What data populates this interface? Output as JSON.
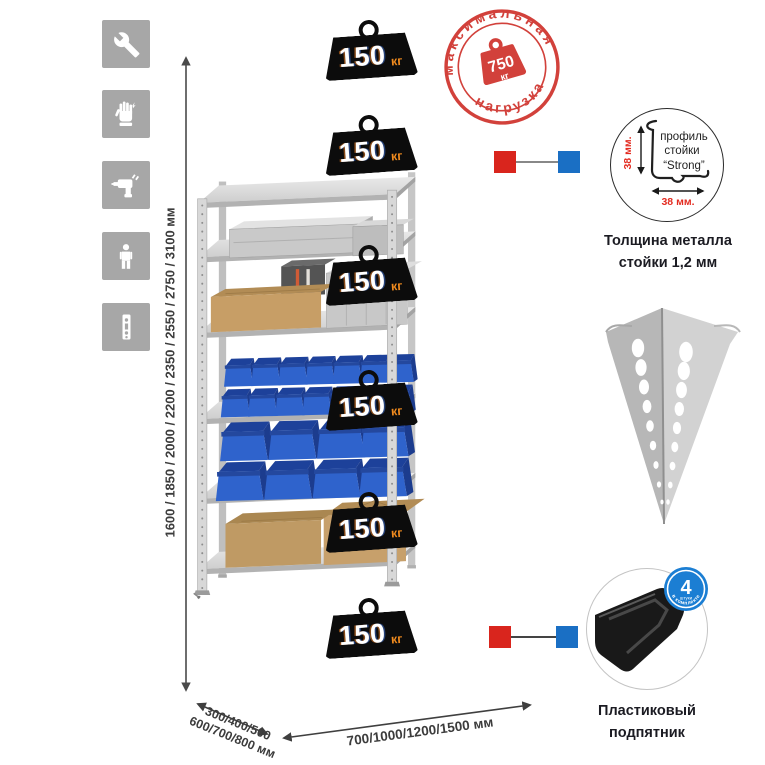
{
  "sidebar": {
    "icons": [
      {
        "name": "wrench"
      },
      {
        "name": "gloves"
      },
      {
        "name": "drill"
      },
      {
        "name": "person"
      },
      {
        "name": "rack-post"
      }
    ]
  },
  "max_load_stamp": {
    "arc_top": "максимальная",
    "arc_bottom": "нагрузка",
    "value": "750",
    "unit": "кг",
    "color": "#d2413b"
  },
  "rack": {
    "shelf_count": 6,
    "load_badges": [
      {
        "value": "150",
        "unit": "кг"
      },
      {
        "value": "150",
        "unit": "кг"
      },
      {
        "value": "150",
        "unit": "кг"
      },
      {
        "value": "150",
        "unit": "кг"
      },
      {
        "value": "150",
        "unit": "кг"
      },
      {
        "value": "150",
        "unit": "кг"
      }
    ],
    "badge_colors": {
      "body": "#0c0c0c",
      "value_text": "#ffffff",
      "unit_text": "#ef8a1e"
    }
  },
  "dimensions": {
    "height": "1600 / 1850 / 2000 / 2200 / 2350 / 2550 / 2750 / 3100 мм",
    "depth_line1": "300/400/500",
    "depth_line2": "600/700/800 мм",
    "width": "700/1000/1200/1500 мм"
  },
  "profile_detail": {
    "label_line1": "профиль",
    "label_line2": "стойки",
    "label_line3": "“Strong”",
    "dim_vertical": "38 мм.",
    "dim_horizontal": "38 мм.",
    "caption_line1": "Толщина металла",
    "caption_line2": "стойки 1,2 мм"
  },
  "foot_detail": {
    "badge_value": "4",
    "badge_word": "штуки",
    "badge_arc": "в комплекте",
    "badge_color": "#1b7ed3",
    "caption_line1": "Пластиковый",
    "caption_line2": "подпятник"
  },
  "callouts": {
    "marker_red": "#d9251d",
    "marker_blue": "#1a6fc4"
  }
}
